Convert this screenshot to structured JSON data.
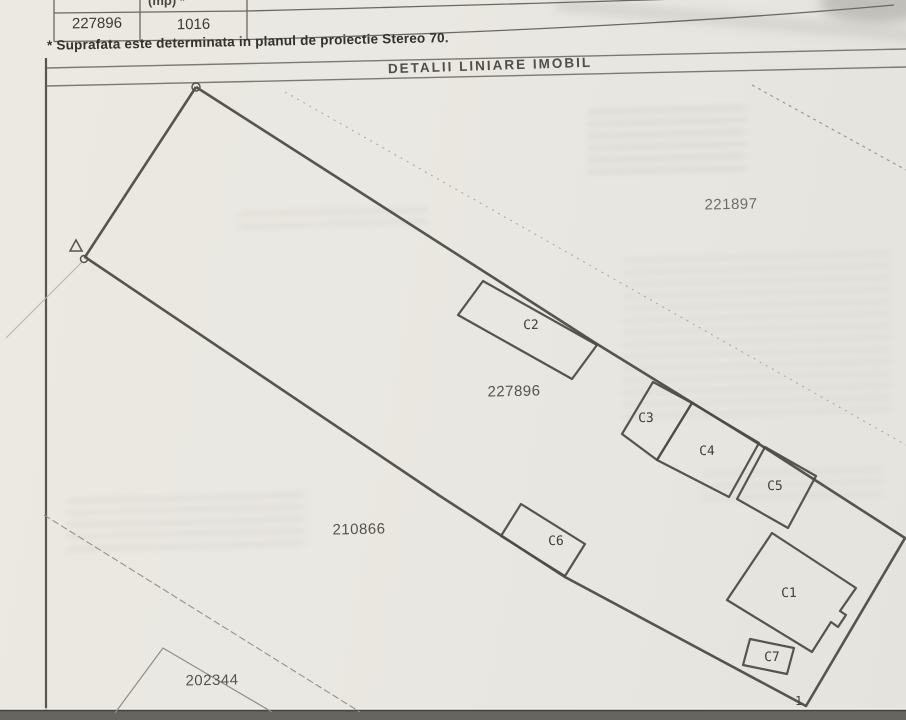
{
  "document": {
    "table": {
      "header_partial": "(mp) *",
      "cells": [
        "227896",
        "1016",
        ""
      ]
    },
    "footnote": "* Suprafata este determinata in planul de proiectie Stereo 70."
  },
  "diagram": {
    "title": "DETALII LINIARE IMOBIL",
    "parcels": {
      "p221897": "221897",
      "p227896": "227896",
      "p210866": "210866",
      "p202344": "202344"
    },
    "buildings": {
      "c1": "C1",
      "c2": "C2",
      "c3": "C3",
      "c4": "C4",
      "c5": "C5",
      "c6": "C6",
      "c7": "C7"
    },
    "points": {
      "pt1": "1"
    },
    "colors": {
      "boundary": "#4e4c46",
      "thin_line": "#8f8d85",
      "paper": "#e9e7e1"
    }
  }
}
